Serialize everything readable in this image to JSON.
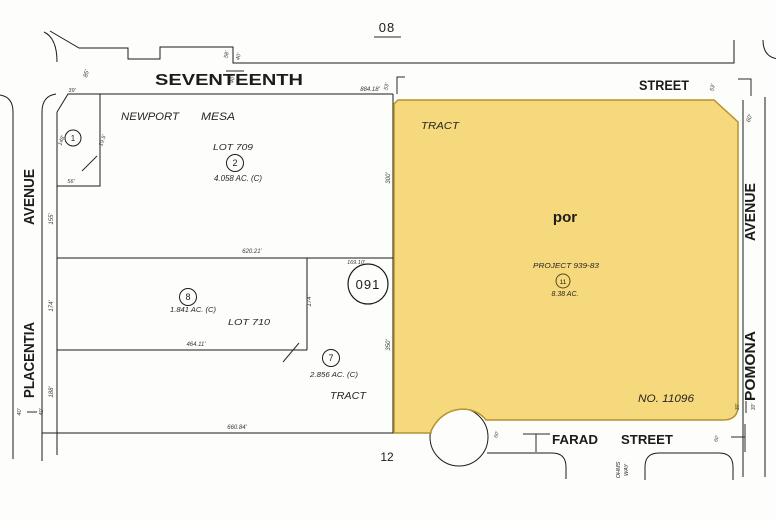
{
  "colors": {
    "highlight": "#f6d97c",
    "outline": "#b2952c",
    "olive": "#97831c",
    "dark_olive": "#55491b",
    "ink": "#1c1c1c"
  },
  "refs": {
    "top": "08",
    "bottom": "12",
    "sheet": "091"
  },
  "streets": {
    "seventeenth": "SEVENTEENTH",
    "seventeenth_type": "STREET",
    "placentia": "PLACENTIA",
    "placentia_type": "AVENUE",
    "pomona": "POMONA",
    "pomona_type": "AVENUE",
    "farad": "FARAD",
    "farad_type": "STREET",
    "ohms_line1": "OHMS",
    "ohms_line2": "WAY"
  },
  "newport_mesa": {
    "word1": "NEWPORT",
    "word2": "MESA",
    "tract_word": "TRACT",
    "lot709": "LOT 709",
    "lot710": "LOT 710",
    "p1": "1",
    "p2": "2",
    "p2_area": "4.058 AC. (C)",
    "p7": "7",
    "p7_area": "2.856 AC. (C)",
    "p8": "8",
    "p8_area": "1.841 AC. (C)"
  },
  "tract11096": {
    "tract_word": "TRACT",
    "por": "por",
    "project": "PROJECT 939-83",
    "p11": "11",
    "p11_area": "8.38 AC.",
    "number": "NO. 11096"
  },
  "dims": {
    "seventeenth_frontage": "884.18'",
    "lot709_south": "620.21'",
    "lot710_south": "464.11'",
    "south_line": "660.84'",
    "p7_north": "169.10'",
    "w85": "85'",
    "w58": "58'",
    "w40_1": "40'",
    "w40_2": "40'",
    "w40_3": "40'",
    "w40_4": "40'",
    "w53_1": "53'",
    "w53_2": "53'",
    "w39": "39'",
    "w148": "148'",
    "w19_5": "19.5'",
    "w56": "56'",
    "w155": "155'",
    "w174_1": "174'",
    "w174_2": "174'",
    "w188": "188'",
    "w300": "300'",
    "w350": "350'",
    "w60_1": "60'",
    "w60_2": "60'",
    "w60_3": "60'",
    "w30_1": "30'",
    "w30_2": "30'"
  }
}
